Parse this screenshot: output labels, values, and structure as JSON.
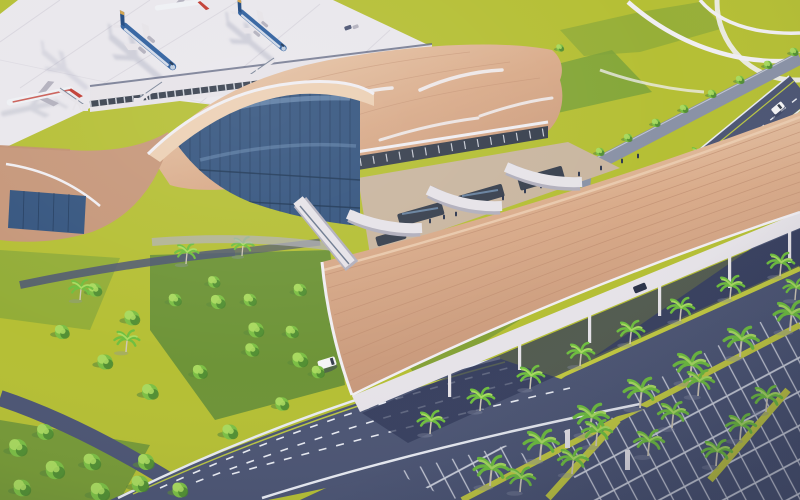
{
  "scene": {
    "title": "Aerial 3D architectural rendering of an airport passenger terminal with elevated access road, apron with aircraft, and palm-lined parking",
    "type": "architectural-rendering",
    "view": "aerial-oblique"
  },
  "colors": {
    "apron": "#e9e7ec",
    "apron-line": "#d9d6de",
    "lawn": "#b5bf35",
    "lawn-dark": "#7da23a",
    "lawn-shadow": "#5d8a3a",
    "tree": "#7cbf45",
    "tree-light": "#a8d95f",
    "tree-dark": "#49842f",
    "palm": "#6fbf3f",
    "palm-light": "#a9dc60",
    "trunk": "#cfc8b6",
    "roof": "#d9ab8a",
    "roof-light": "#ecd0b4",
    "roof-dark": "#c6977a",
    "roof-rib": "#c08f72",
    "structure": "#e6e3e8",
    "structure-dark": "#b2b0bd",
    "glass": "#35557f",
    "glass-light": "#7d9ec2",
    "mullion": "#1d3453",
    "well": "#39414f",
    "floor": "#c9b6a0",
    "road": "#4d5674",
    "road-light": "#8a92a6",
    "road-shadow": "#333b59",
    "line-white": "#e8ebf2",
    "line-green": "#b9c544",
    "median": "#c3ca41",
    "path-white": "#f0eef2",
    "plane-blue": "#2e5f9e",
    "plane-dark": "#1d477f",
    "plane-white": "#eef0f4",
    "plane-gold": "#d2a24a",
    "plane-red": "#c03a30",
    "vehicle-white": "#f4f4f6",
    "vehicle-dark": "#2b3248",
    "people": "#2e3850",
    "shadow": "#8d93a8"
  },
  "objects": {
    "aircraft_blue_parked": 2,
    "aircraft_partial_white_red": 2,
    "jet_bridges": 3,
    "vehicles": {
      "white_van_on_ramp": 1,
      "dark_car_under_canopy": 1,
      "white_car_exit_road": 1,
      "ground_support_units": 1
    },
    "buildings": [
      "main-terminal",
      "concourse-pier",
      "left-wing",
      "drop-off-canopy",
      "elevated-viaduct"
    ],
    "landscape": [
      "palm-medians",
      "lawns",
      "round-trees",
      "parking-stalls",
      "footpaths"
    ]
  }
}
